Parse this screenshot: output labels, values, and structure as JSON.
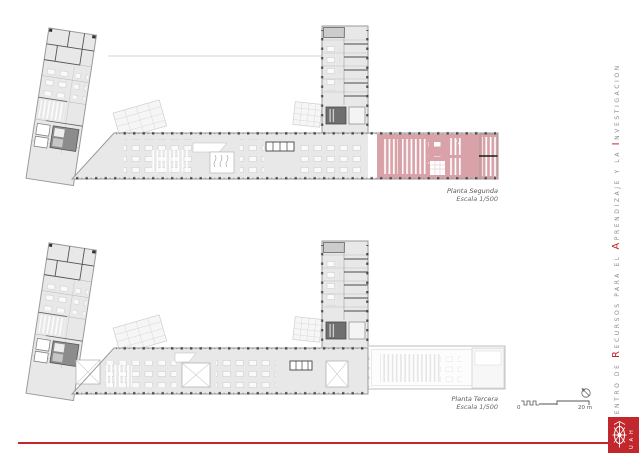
{
  "document": {
    "plans": [
      {
        "name": "Planta Segunda",
        "scale": "Escala 1/500"
      },
      {
        "name": "Planta Tercera",
        "scale": "Escala 1/500"
      }
    ],
    "side_title": {
      "full": "Centro de Recursos para el Aprendizaje y la Investigacion",
      "segments": [
        {
          "t": "C"
        },
        {
          "t": "ENTRO DE "
        },
        {
          "t": "R"
        },
        {
          "t": "ECURSOS PARA EL "
        },
        {
          "t": "A"
        },
        {
          "t": "PRENDIZAJE Y LA "
        },
        {
          "t": "I"
        },
        {
          "t": "NVESTIGACION"
        }
      ]
    },
    "scale_bar": {
      "start_label": "0",
      "end_label": "20 m"
    },
    "logo": {
      "letters": "U A H"
    },
    "colors": {
      "accent_red": "#c1272d",
      "highlight_pink": "#d9a2a8",
      "building_fill": "#e8e8e8",
      "wall_gray": "#9a9a9a"
    }
  }
}
